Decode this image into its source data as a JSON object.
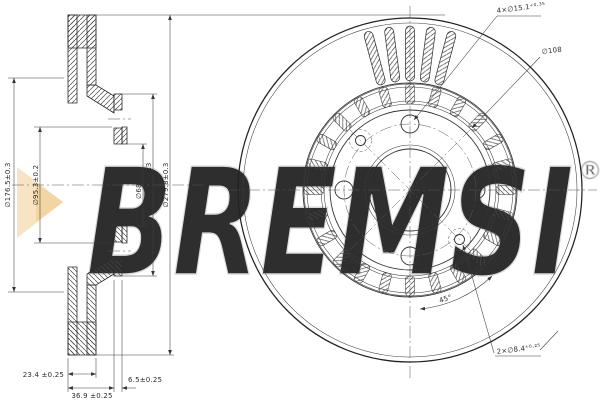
{
  "drawing": {
    "watermark": {
      "brand": "BREMSI",
      "registered_mark": "®",
      "outline_color": "#d9d9d9",
      "triangle_color": "#f8e4c2",
      "triangle_tip_color": "#f2d5a2"
    },
    "section_view": {
      "dims": {
        "outer_diameter": "∅279.8±0.3",
        "hat_diameter": "∅150.4±0.3",
        "bore_diameter": "∅68⁺⁰·¹",
        "friction_inner_diameter": "∅176.5±0.3",
        "pilot_diameter": "∅95.3±0.2",
        "disc_thickness": "23.4 ±0.25",
        "overall_height": "36.9 ±0.25",
        "flange_thickness": "6.5±0.25"
      }
    },
    "face_view": {
      "dims": {
        "bolt_holes": "4×∅15.1⁺⁰·³⁵",
        "bolt_circle": "∅108",
        "pin_holes": "2×∅8.4⁺⁰·²⁵",
        "pin_angle": "45°"
      }
    }
  }
}
